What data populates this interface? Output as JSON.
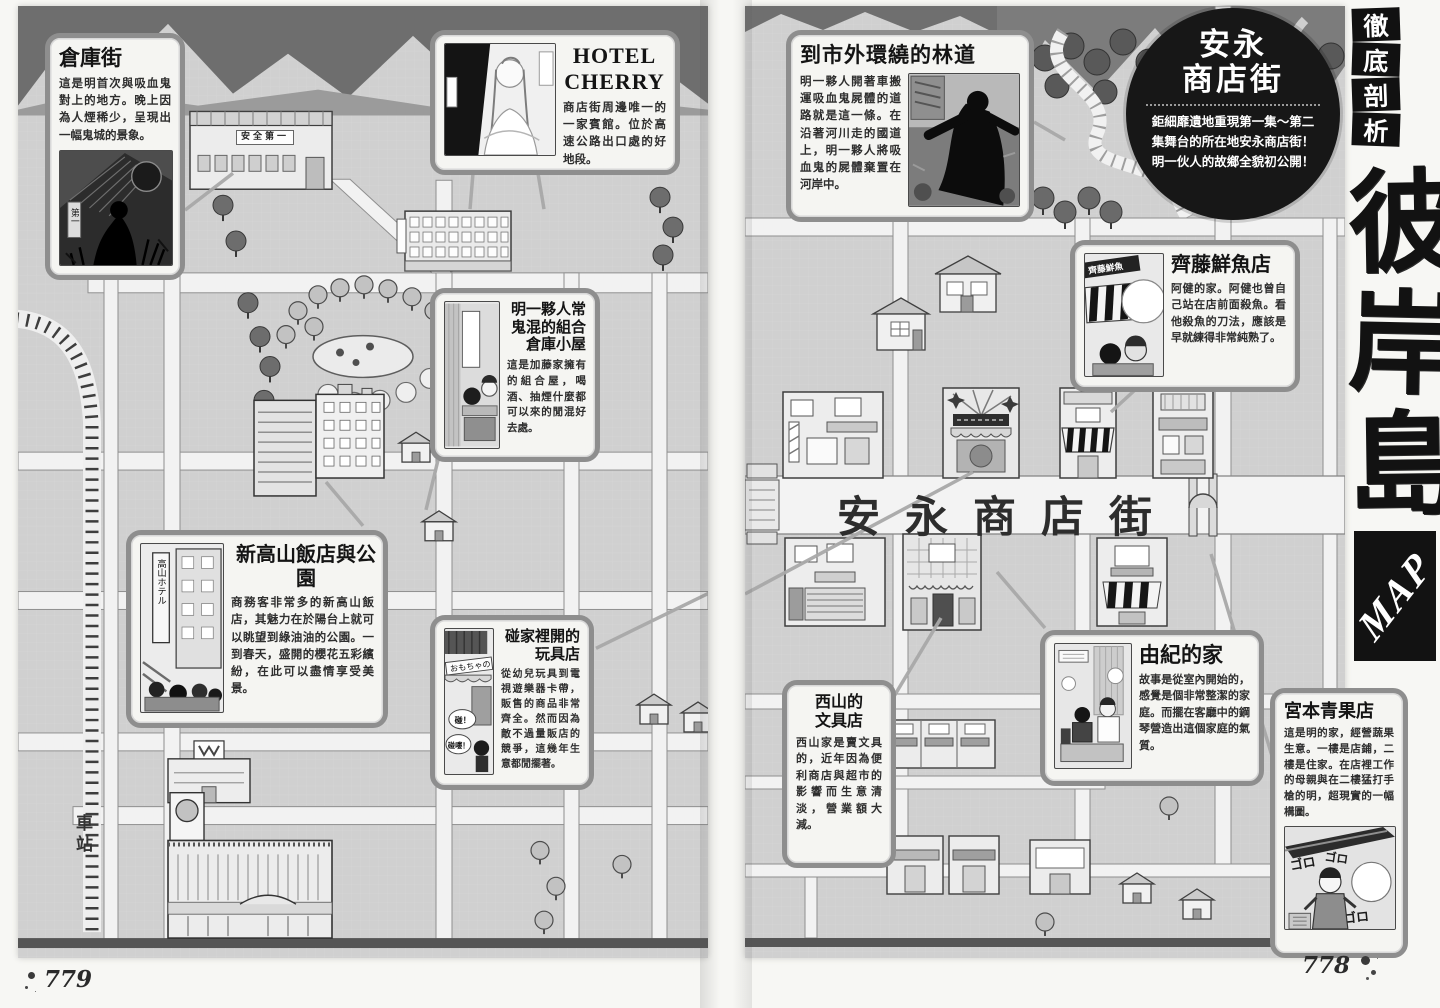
{
  "page": {
    "left_number": "779",
    "right_number": "778"
  },
  "sidebar": {
    "banner": [
      "徹",
      "底",
      "剖",
      "析"
    ],
    "title_chars": [
      "彼",
      "岸",
      "島"
    ],
    "map_label": "MAP"
  },
  "map": {
    "street_label": "安永商店街",
    "station_label": "車站",
    "warehouse_sign": "安全第一"
  },
  "callouts": {
    "warehouse_district": {
      "title": "倉庫街",
      "body": "這是明首次與吸血鬼對上的地方。晚上因為人煙稀少，呈現出一幅鬼城的景象。"
    },
    "hotel_cherry": {
      "title": "HOTEL CHERRY",
      "body": "商店街周邊唯一的一家賓館。位於高速公路出口處的好地段。"
    },
    "prefab_cabin": {
      "title": "明一夥人常鬼混的組合倉庫小屋",
      "body": "這是加藤家擁有的組合屋，喝酒、抽煙什麼都可以來的閒混好去處。"
    },
    "hotel_park": {
      "title": "新高山飯店與公園",
      "body": "商務客非常多的新高山飯店，其魅力在於陽台上就可以眺望到綠油油的公園。一到春天，盛開的櫻花五彩繽紛，在此可以盡情享受美景。"
    },
    "toy_shop": {
      "title": "碰家裡開的玩具店",
      "body": "從幼兒玩具到電視遊樂器卡帶，販售的商品非常齊全。然而因為敵不過量販店的競爭，這幾年生意都閒擺著。"
    },
    "forest_road": {
      "title": "到市外環繞的林道",
      "body": "明一夥人開著車搬運吸血鬼屍體的道路就是這一條。在沿著河川走的國道上，明一夥人將吸血鬼的屍體棄置在河岸中。"
    },
    "street_badge": {
      "title_lines": [
        "安永",
        "商店街"
      ],
      "body": "鉅細靡遺地重現第一集～第二集舞台的所在地安永商店街！明一伙人的故鄉全貌初公開！"
    },
    "saito_fish": {
      "title": "齊藤鮮魚店",
      "body": "阿健的家。阿健也曾自己站在店前面殺魚。看他殺魚的刀法，應該是早就練得非常純熟了。"
    },
    "yuki_home": {
      "title": "由紀的家",
      "body": "故事是從室內開始的，感覺是個非常整潔的家庭。而擺在客廳中的鋼琴營造出這個家庭的氣質。"
    },
    "nishiyama_stationery": {
      "title": "西山的文具店",
      "body": "西山家是賣文具的，近年因為便利商店與超市的影響而生意清淡，營業額大減。"
    },
    "miyamoto_fruit": {
      "title": "宮本青果店",
      "body": "這是明的家，經營蔬果生意。一樓是店鋪，二樓是住家。在店裡工作的母親與在二樓猛打手槍的明，超現實的一幅構圖。"
    }
  },
  "scenes": {
    "warehouse_banner": "第一",
    "hotel_sign": "高山ホテル",
    "toy_sign": "おもちゃの",
    "toy_bubble_a": "碰！",
    "toy_bubble_b": "碰嘍！",
    "fish_sign": "齊藤鮮魚",
    "fruit_sfx": "ゴロ"
  }
}
